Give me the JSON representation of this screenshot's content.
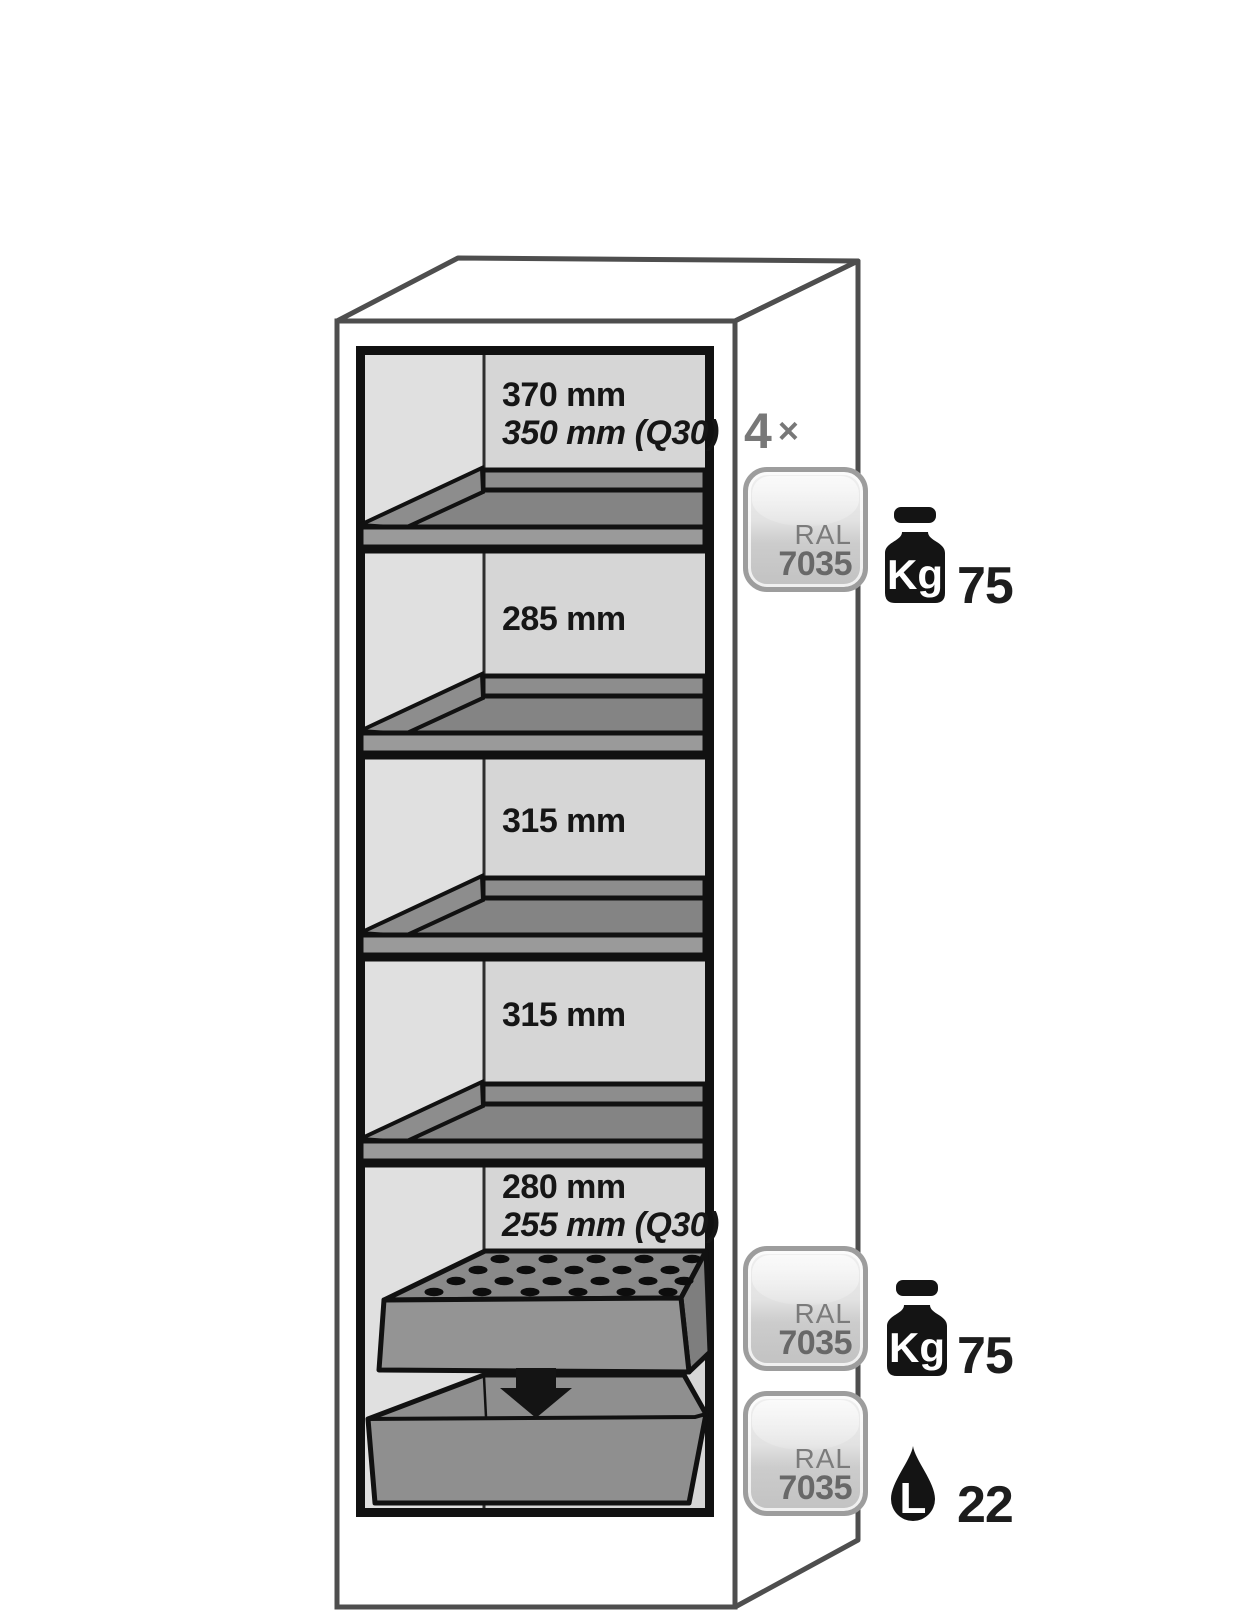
{
  "figure": {
    "description": "Safety cabinet interior equipment diagram",
    "count": "4",
    "times_symbol": "×",
    "compartments": [
      {
        "line1": "370 mm",
        "line2": "350 mm (Q30)"
      },
      {
        "line1": "285 mm",
        "line2": ""
      },
      {
        "line1": "315 mm",
        "line2": ""
      },
      {
        "line1": "315 mm",
        "line2": ""
      },
      {
        "line1": "280 mm",
        "line2": "255 mm (Q30)"
      }
    ],
    "badge": {
      "label": "RAL",
      "code": "7035"
    },
    "specs": [
      {
        "icon": "weight-kg-icon",
        "unit": "Kg",
        "value": "75"
      },
      {
        "icon": "weight-kg-icon",
        "unit": "Kg",
        "value": "75"
      },
      {
        "icon": "liquid-drop-icon",
        "unit": "L",
        "value": "22"
      }
    ],
    "colors": {
      "outline": "#4e4e4e",
      "detail_line": "#111111",
      "interior_left_wall": "#e0e0e0",
      "interior_back_wall": "#d6d6d6",
      "shelf_gray": "#848484",
      "shelf_front_gray": "#9a9a9a",
      "badge_border": "#9d9d9d",
      "muted_text": "#787878",
      "dark_text": "#1d1d1d"
    }
  }
}
